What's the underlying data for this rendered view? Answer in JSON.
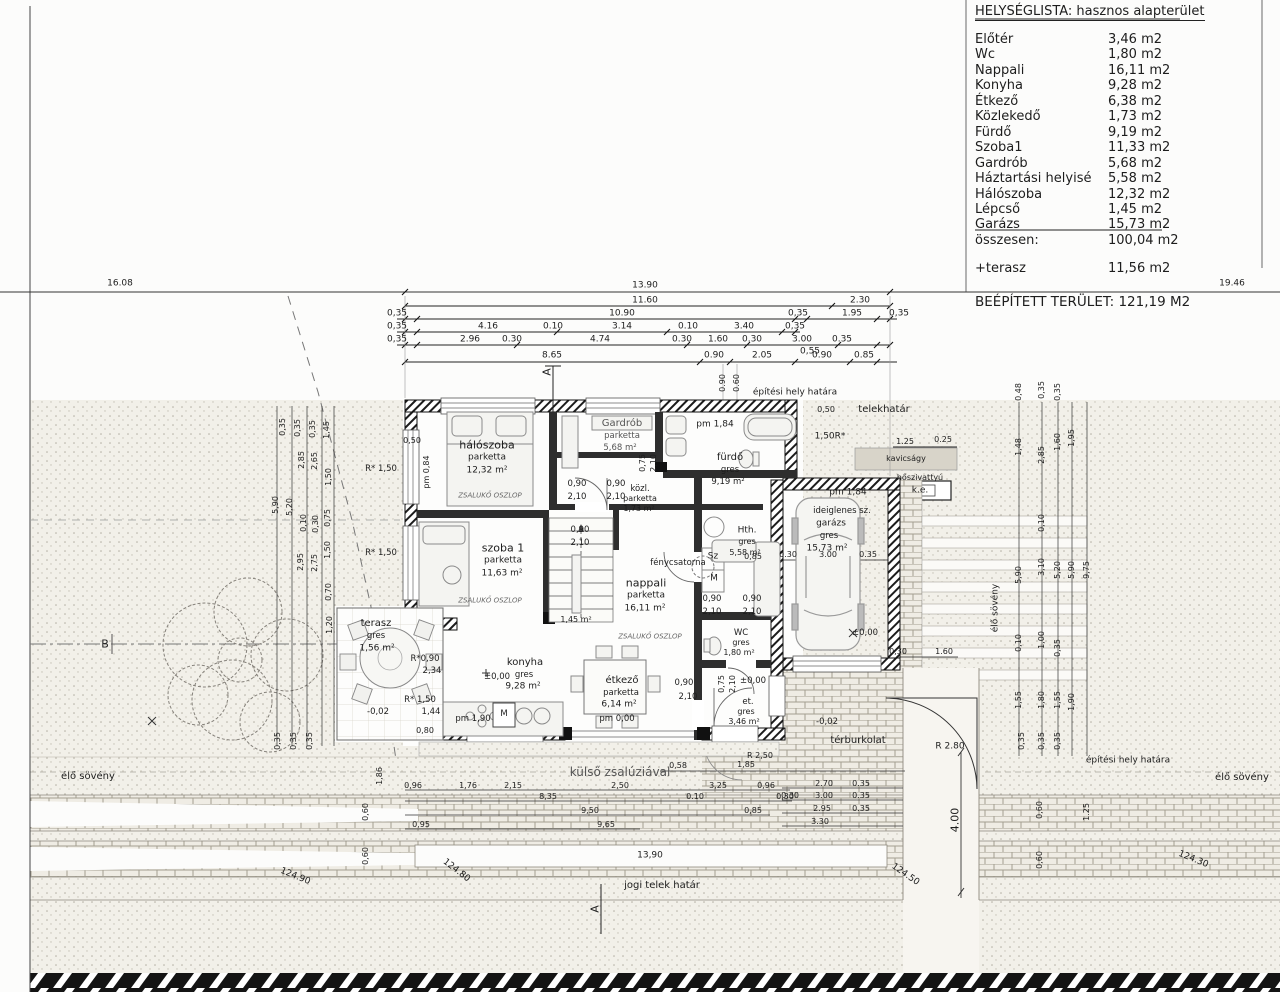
{
  "table": {
    "title": "HELYSÉGLISTA:  hasznos alapterület",
    "rows": [
      [
        "Előtér",
        "3,46 m2"
      ],
      [
        "Wc",
        "1,80 m2"
      ],
      [
        "Nappali",
        "16,11 m2"
      ],
      [
        "Konyha",
        "9,28 m2"
      ],
      [
        "Étkező",
        "6,38 m2"
      ],
      [
        "Közlekedő",
        "1,73 m2"
      ],
      [
        "Fürdő",
        "9,19 m2"
      ],
      [
        "Szoba1",
        "11,33 m2"
      ],
      [
        "Gardrób",
        "5,68 m2"
      ],
      [
        "Háztartási helyisé",
        "5,58 m2"
      ],
      [
        "Hálószoba",
        "12,32 m2"
      ],
      [
        "Lépcső",
        "1,45 m2"
      ],
      [
        "Garázs",
        "15,73 m2"
      ],
      [
        "összesen:",
        "100,04 m2"
      ]
    ],
    "terasz": [
      "+terasz",
      "11,56 m2"
    ],
    "beepitett": "BEÉPÍTETT TERÜLET: 121,19 M2"
  },
  "site": {
    "d1608": "16.08",
    "d1946": "19.46",
    "d1390b": "13,90",
    "epitesi_top": "építési hely határa",
    "epitesi_right": "építési hely határa",
    "telekhatar": "telekhatár",
    "kavicsagy": "kavicságy",
    "hoszivattyu": "hőszivattyú",
    "ke": "k.e.",
    "elo_soveny": "élő sövény",
    "jogi": "jogi telek határ",
    "terburkolat": "térburkolat",
    "kulso": "külső zsalúziával",
    "r280": "R 2.80",
    "r250": "R 2,50",
    "d400": "4.00",
    "d12490": "124.90",
    "d12480": "124.80",
    "d12450": "124.50",
    "d12430": "124.30",
    "a_marker": "A",
    "b_marker": "B"
  },
  "rooms": {
    "halo": [
      "hálószoba",
      "parketta",
      "12,32 m²"
    ],
    "gardrob": [
      "Gardrób",
      "parketta",
      "5,68 m²"
    ],
    "furdo": [
      "fürdő",
      "gres",
      "9,19 m²"
    ],
    "kozl": [
      "közl.",
      "parketta",
      "1,73 m²"
    ],
    "szoba": [
      "szoba 1",
      "parketta",
      "11,63 m²"
    ],
    "nappali": [
      "nappali",
      "parketta",
      "16,11 m²"
    ],
    "hth": [
      "Hth.",
      "gres",
      "5,58 m²"
    ],
    "garazs": [
      "ideiglenes sz.",
      "garázs",
      "gres",
      "15,73 m²"
    ],
    "terasz": [
      "terasz",
      "gres",
      "1,56 m²"
    ],
    "konyha": [
      "konyha",
      "gres",
      "9,28 m²"
    ],
    "etkezo": [
      "étkező",
      "parketta",
      "6,14 m²"
    ],
    "wc": [
      "WC",
      "gres",
      "1,80 m²"
    ],
    "eloter": [
      "et.",
      "gres",
      "3,46 m²"
    ],
    "fenycsatorna": "fénycsatorna",
    "lepcso": "1,45 m²"
  },
  "ann": {
    "pm184": "pm 1,84",
    "pm000": "pm 0,00",
    "pm190": "pm 1,90",
    "pm084": "pm 0,84",
    "zero": "±0,00",
    "m002": "-0,02",
    "zsaluko": "ZSALUKŐ OSZLOP",
    "d090": "0,90",
    "d210": "2,10",
    "d075": "0,75",
    "sz": "Sz",
    "m": "M",
    "r090": "R*0,90",
    "d234": "2,34",
    "r150": "R* 1,50",
    "d144": "1,44",
    "d080": "0,80",
    "d050": "0,50",
    "d085": "0,85",
    "r150b": "1,50R*",
    "d125": "1.25",
    "d025": "0.25",
    "d058": "0,58",
    "d185": "1,85",
    "d060": "0,60",
    "d035": "0,35"
  },
  "dims": {
    "t1": "13.90",
    "t2": [
      "11.60",
      "2.30"
    ],
    "t3": [
      "0,35",
      "10.90",
      "0,35",
      "1.95",
      "0,35"
    ],
    "t4": [
      "0,35",
      "4.16",
      "0.10",
      "3.14",
      "0.10",
      "3.40",
      "0,35"
    ],
    "t5": [
      "0,35",
      "2.96",
      "0.30",
      "4.74",
      "0.30",
      "1.60",
      "0.30",
      "3.00",
      "0.35",
      "0,55"
    ],
    "t6": [
      "8.65",
      "0.90",
      "2.05",
      "0.90",
      "0.85"
    ],
    "door_v": [
      "0.90",
      "0.60"
    ],
    "gar_top": [
      "0.30",
      "3.00",
      "0.35"
    ],
    "gar_bot": [
      "0,30",
      "1.60"
    ],
    "bl1": [
      "0,96",
      "1,76",
      "2,15",
      "2,50",
      "3,25",
      "0,96"
    ],
    "bl2": [
      "8,35",
      "0.10",
      "0,30"
    ],
    "bl3": [
      "9,50",
      "0,85"
    ],
    "bl4": [
      "0,95",
      "9,65"
    ],
    "bl5": "13,90",
    "br1": [
      "2.70",
      "0.35"
    ],
    "br2": [
      "0.30",
      "3.00",
      "0.35"
    ],
    "br3": [
      "2.95",
      "0.35"
    ],
    "br4": "3.30",
    "lcol": [
      "0,35",
      "0,35",
      "0,35",
      "1,45",
      "2,85",
      "2,65",
      "1,50",
      "5,90",
      "5,20",
      "0,10",
      "0,30",
      "0,75",
      "2,95",
      "2,75",
      "1,50",
      "0,70",
      "1,20",
      "1,86"
    ],
    "rcol": [
      "0,48",
      "1,48",
      "5,90",
      "0,10",
      "1,55",
      "0,35",
      "2,85",
      "0,10",
      "3,10",
      "1,00",
      "1,80",
      "0,35",
      "1,60",
      "5,20",
      "0,35",
      "1,55",
      "1,95",
      "5,90",
      "1,90",
      "9,75"
    ]
  }
}
